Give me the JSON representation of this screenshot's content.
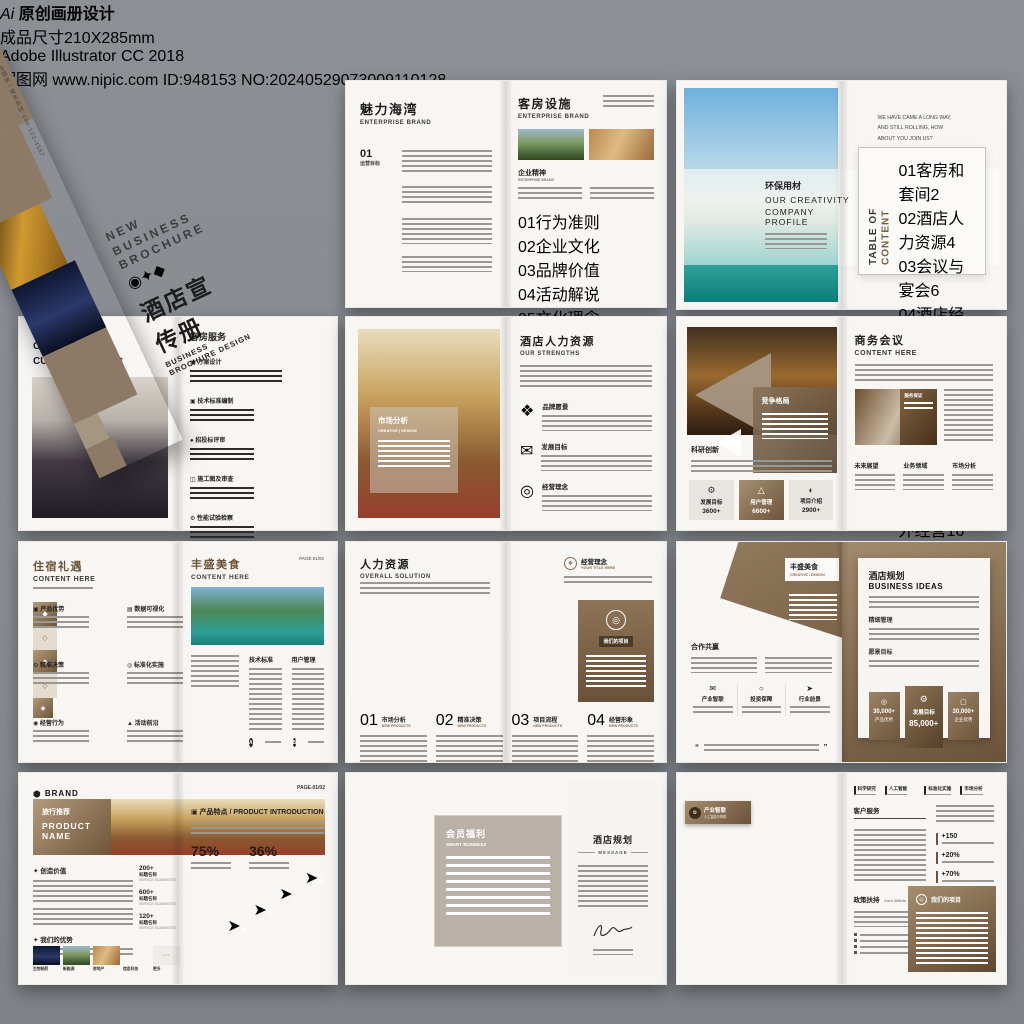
{
  "header": {
    "ai": "Ai",
    "badge1": "原创画册设计",
    "badge2": "成品尺寸210X285mm",
    "badge3": "Adobe Illustrator CC 2018"
  },
  "footer": {
    "site": "昵图网",
    "url": "www.nipic.com",
    "id": "ID:948153 NO:20240529073009110128"
  },
  "cover": {
    "logo": "YOUR LOGO",
    "logo_sub": "Creative Design",
    "t1": "NEW",
    "t2": "BUSINESS",
    "t3": "BROCHURE",
    "cn": "酒店宣传册",
    "en": "BUSINESS BROCHURE DESIGN",
    "hotline": "全国统一服务热线 400-123-4567"
  },
  "a": {
    "lt": "魅力海湾",
    "ls": "ENTERPRISE BRAND",
    "num": "01",
    "numlabel": "运营目标",
    "rt": "客房设施",
    "rs": "ENTERPRISE BRAND",
    "sec": "企业精神",
    "secs": "ENTERPRISE BRAND",
    "sliders": [
      {
        "n": "01",
        "label": "行为准则",
        "pct": 78
      },
      {
        "n": "02",
        "label": "企业文化",
        "pct": 55
      },
      {
        "n": "03",
        "label": "品牌价值",
        "pct": 65
      },
      {
        "n": "04",
        "label": "活动解说",
        "pct": 70
      },
      {
        "n": "05",
        "label": "文化理念",
        "pct": 48
      },
      {
        "n": "06",
        "label": "服务保障",
        "pct": 85
      },
      {
        "n": "07",
        "label": "企业思想",
        "pct": 62
      },
      {
        "n": "08",
        "label": "销售业绩",
        "pct": 75
      }
    ]
  },
  "b": {
    "cn": "环保用材",
    "en1": "OUR CREATIVITY",
    "en2": "COMPANY PROFILE",
    "i1": "WE HAVE CAME A LONG WAY,",
    "i2": "AND STILL ROLLING, HOW",
    "i3": "ABOUT YOU JOIN US?",
    "toc1": "TABLE OF",
    "toc2": "CONTENT",
    "toc": [
      {
        "n": "01",
        "label": "客房和套间",
        "p": "2"
      },
      {
        "n": "02",
        "label": "酒店人力资源",
        "p": "4"
      },
      {
        "n": "03",
        "label": "会议与宴会",
        "p": "6"
      },
      {
        "n": "04",
        "label": "酒店经营",
        "p": "8"
      },
      {
        "n": "05",
        "label": "商务会议",
        "p": "10"
      },
      {
        "n": "06",
        "label": "客房服务",
        "p": "12"
      },
      {
        "n": "07",
        "label": "客房设施",
        "p": "14"
      },
      {
        "n": "08",
        "label": "酒店涉外经营",
        "p": "16"
      }
    ]
  },
  "c": {
    "logo": "LOGO /",
    "t1": "CORPORATE",
    "t2": "CULTURE 商品展会",
    "rt": "客房服务",
    "items": [
      "方案设计",
      "技术标准编制",
      "招投标评审",
      "施工图及审查",
      "性能试验检察",
      "质量控制检查",
      "验收配合"
    ]
  },
  "d": {
    "ov": "市场分析",
    "ovs": "CREATIVE | DESIGN",
    "rt": "酒店人力资源",
    "rs": "OUR STRENGTHS",
    "items": [
      {
        "label": "品牌愿景"
      },
      {
        "label": "发展目标"
      },
      {
        "label": "经营理念"
      }
    ]
  },
  "e": {
    "panel": "竞争格局",
    "sec": "科研创新",
    "stats": [
      {
        "label": "发展目标",
        "value": "3600+"
      },
      {
        "label": "用户管理",
        "value": "6600+"
      },
      {
        "label": "项目介绍",
        "value": "2900+"
      }
    ],
    "rt": "商务会议",
    "rs": "CONTENT HERE",
    "cap": "服务保证",
    "cols": [
      "未来展望",
      "业务领域",
      "市场分析"
    ]
  },
  "f": {
    "lt": "住宿礼遇",
    "ls": "CONTENT HERE",
    "steps": [
      "产品优势",
      "数据可视化",
      "精准决策",
      "标准化实施",
      "经营行为",
      "活动前沿"
    ],
    "rt": "丰盛美食",
    "rs": "CONTENT HERE",
    "page": "PAGE 01/02",
    "c1": "技术标准",
    "c2": "用户管理",
    "b1": "A",
    "b2": "B"
  },
  "g": {
    "lt": "人力资源",
    "ls": "OVERALL SOLUTION",
    "rt": "经营理念",
    "rs": "YOUR TITLE HERE",
    "panel": "我们的项目",
    "items": [
      {
        "n": "01",
        "label": "市场分析",
        "sub": "NEW PRODUCTS"
      },
      {
        "n": "02",
        "label": "精准决策",
        "sub": "NEW PRODUCTS"
      },
      {
        "n": "03",
        "label": "项目流程",
        "sub": "NEW PRODUCTS"
      },
      {
        "n": "04",
        "label": "经营形象",
        "sub": "NEW PRODUCTS"
      }
    ]
  },
  "h": {
    "lt": "丰盛美食",
    "ls": "CREATIVE / DESIGN",
    "sec": "合作共赢",
    "feats": [
      "产业智联",
      "投资保障",
      "行业前景"
    ],
    "rt": "酒店规划",
    "rs": "BUSINESS IDEAS",
    "sub1": "精细管理",
    "sub2": "愿景目标",
    "stats": [
      {
        "value": "30,000+",
        "label": "产品优势"
      },
      {
        "label": "发展目标",
        "value": "85,000+"
      },
      {
        "value": "30,000+",
        "label": "企业优势"
      }
    ]
  },
  "i": {
    "brand": "BRAND",
    "page": "PAGE-01/02",
    "bn_cn": "旅行推荐",
    "bn1": "PRODUCT",
    "bn2": "NAME",
    "s1": "创造价值",
    "stats": [
      {
        "value": "200+",
        "label": "标题名称",
        "sub": "SERVICE GUARANTEE"
      },
      {
        "value": "600+",
        "label": "标题名称",
        "sub": "SERVICE GUARANTEE"
      },
      {
        "value": "120+",
        "label": "标题名称",
        "sub": "SERVICE GUARANTEE"
      }
    ],
    "s2": "我们的优势",
    "thumbs": [
      "生物制药",
      "新能源",
      "房地产",
      "信息科技",
      "更多"
    ],
    "more": "···",
    "rt": "产品特点 / PRODUCT INTRODUCTION",
    "p1": "75%",
    "p2": "36%"
  },
  "j": {
    "ov": "会员福利",
    "ovs": "SMART BUSINESS",
    "f1": "招商加盟",
    "f2": "产业智联",
    "rt": "酒店规划",
    "rs": "MESSAGE"
  },
  "k": {
    "tag": "产业智联",
    "tags": "人工智能与物联",
    "nav": [
      "科学研究",
      "人工智能",
      "标准化实施",
      "市场分析"
    ],
    "s1": "客户服务",
    "stats": [
      "+150",
      "+20%",
      "+70%"
    ],
    "s2": "政策扶持",
    "s2en": "Core Within",
    "box": "我们的项目"
  }
}
